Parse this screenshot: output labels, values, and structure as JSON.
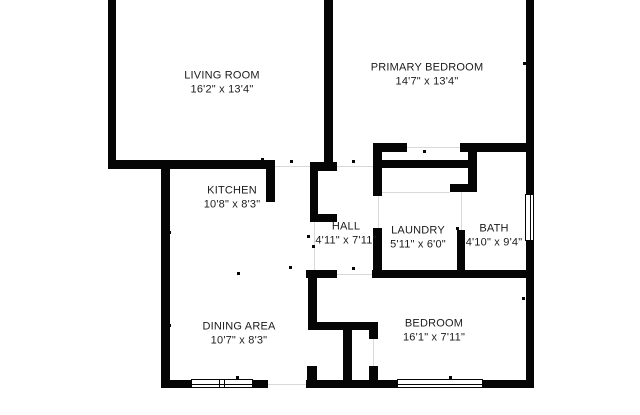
{
  "colors": {
    "wall": "#050505",
    "background": "#ffffff",
    "label": "#1b1b1b",
    "guide": "#d9d9d9"
  },
  "rooms": [
    {
      "name": "LIVING ROOM",
      "dimensions": "16'2\" x 13'4\""
    },
    {
      "name": "PRIMARY BEDROOM",
      "dimensions": "14'7\" x 13'4\""
    },
    {
      "name": "KITCHEN",
      "dimensions": "10'8\" x 8'3\""
    },
    {
      "name": "HALL",
      "dimensions": "4'11\" x 7'11\""
    },
    {
      "name": "LAUNDRY",
      "dimensions": "5'11\" x 6'0\""
    },
    {
      "name": "BATH",
      "dimensions": "4'10\" x 9'4\""
    },
    {
      "name": "DINING AREA",
      "dimensions": "10'7\" x 8'3\""
    },
    {
      "name": "BEDROOM",
      "dimensions": "16'1\" x 7'11\""
    }
  ]
}
